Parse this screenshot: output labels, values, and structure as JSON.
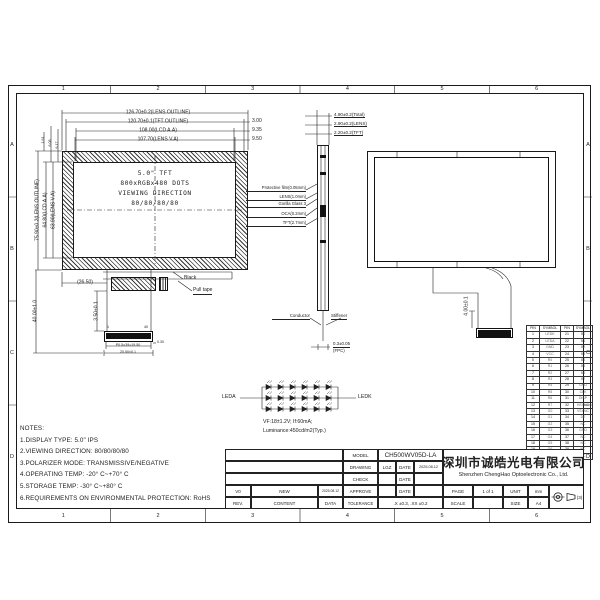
{
  "frame": {
    "columns": [
      "1",
      "2",
      "3",
      "4",
      "5",
      "6"
    ],
    "rows": [
      "A",
      "B",
      "C",
      "D"
    ]
  },
  "front_view": {
    "center": {
      "l1": "5.0\" TFT",
      "l2": "800xRGBx480 DOTS",
      "l3": "VIEWING DIRECTION",
      "l4": "80/80/80/80"
    },
    "dims_top": [
      "126.70±0.2(LENS OUTLINE)",
      "120.70±0.1(TFT OUTLINE)",
      "108.00(LCD A.A)",
      "107.70(LENS V.A)"
    ],
    "dims_right": [
      "3.00",
      "9.35",
      "9.50"
    ],
    "dims_left": [
      "75.90±0.2(LENS OUTLINE)",
      "64.80(LCD A.A)",
      "63.90(LENS V.A)"
    ],
    "dims_left_top": [
      "1.61",
      "6.08",
      "6.17"
    ],
    "fpc": {
      "offset": "(26.50)",
      "total_len": "40.00±1.0",
      "len": "3.50±0.1",
      "pin1": "1",
      "pin40": "40",
      "pitch": "P0.5×39=19.50",
      "width": "20.50±0.1",
      "thk": "0.30"
    },
    "black_label": "Black",
    "pull_tape_label": "Pull tape"
  },
  "side_view": {
    "dims_top": [
      "4.90±0.2(Total)",
      "2.90±0.2(LENS)",
      "2.20±0.2(TFT)"
    ],
    "stack": [
      "Protective film(0.05mm)",
      "LENS(1.0mm)",
      "Gorilla Glass 3",
      "OCA(0.2mm)",
      "TFT(2.7mm)"
    ],
    "conductor": "Conductor",
    "stiffener": "Stiffener",
    "fpc_thk": "0.3±0.05",
    "fpc": "(FPC)"
  },
  "back_view": {
    "fpc_dim": "4.00±0.1"
  },
  "led": {
    "leda": "LEDA",
    "ledk": "LEDK",
    "rows": 3,
    "cols": 6,
    "vf": "VF:18±1.2V;  If:60mA;",
    "luminance": "Luminance:450cd/m2(Typ.)"
  },
  "notes": {
    "title": "NOTES:",
    "items": [
      "1.DISPLAY TYPE:  5.0\" IPS",
      "2.VIEWING DIRECTION: 80/80/80/80",
      "3.POLARIZER MODE: TRANSMISSIVE/NEGATIVE",
      "4.OPERATING TEMP: -20° C~+70° C",
      "5.STORAGE TEMP: -30° C~+80° C",
      "6.REQUIREMENTS ON ENVIRONMENTAL PROTECTION: RoHS"
    ]
  },
  "pin_table": {
    "headers": [
      "PIN",
      "SYMBOL",
      "PIN",
      "SYMBOL"
    ],
    "rows": [
      [
        "1",
        "LEDK",
        "21",
        "B0"
      ],
      [
        "2",
        "LEDA",
        "22",
        "B1"
      ],
      [
        "3",
        "GND",
        "23",
        "B2"
      ],
      [
        "4",
        "VCC",
        "24",
        "B3"
      ],
      [
        "5",
        "R0",
        "25",
        "B4"
      ],
      [
        "6",
        "R1",
        "26",
        "B5"
      ],
      [
        "7",
        "R2",
        "27",
        "B6"
      ],
      [
        "8",
        "R3",
        "28",
        "B7"
      ],
      [
        "9",
        "R4",
        "29",
        "GND"
      ],
      [
        "10",
        "R5",
        "30",
        "CLK"
      ],
      [
        "11",
        "R6",
        "31",
        "DISP"
      ],
      [
        "12",
        "R7",
        "32",
        "HSYNC"
      ],
      [
        "13",
        "G0",
        "33",
        "VSYNC"
      ],
      [
        "14",
        "G1",
        "34",
        "DE"
      ],
      [
        "15",
        "G2",
        "35",
        "NC"
      ],
      [
        "16",
        "G3",
        "36",
        "GND"
      ],
      [
        "17",
        "G4",
        "37",
        "NC"
      ],
      [
        "18",
        "G5",
        "38",
        "NC"
      ],
      [
        "19",
        "G6",
        "39",
        "NC"
      ],
      [
        "20",
        "G7",
        "40",
        "NC"
      ]
    ]
  },
  "title_block": {
    "model_label": "MODEL",
    "model": "CH500WV05D-LA",
    "drawing_label": "DRAWING",
    "drawing_by": "LGZ",
    "date_label": "DATE",
    "drawing_date": "2025.08.12",
    "check_label": "CHECK",
    "approve_label": "APPROVE",
    "tolerance_label": "TOLERANCE",
    "tolerance_value": ".X ±0.3, .XX ±0.2",
    "page_label": "PAGE",
    "page_value": "1 of 1",
    "unit_label": "UNIT",
    "unit_value": "mm",
    "scale_label": "SCALE",
    "size_label": "SIZE",
    "size_value": "A4",
    "rev_row": {
      "rev": "V0",
      "content": "NEW",
      "date": "2025.08.12"
    },
    "rev_header": {
      "rev": "REV.",
      "content": "CONTENT",
      "date": "DATA"
    },
    "projection_note": "(3)"
  },
  "company": {
    "cn": "深圳市诚皓光电有限公司",
    "en": "Shenzhen ChengHao Optoelectronic Co., Ltd."
  },
  "colors": {
    "line": "#222222",
    "bg": "#ffffff",
    "fill": "#111111"
  }
}
